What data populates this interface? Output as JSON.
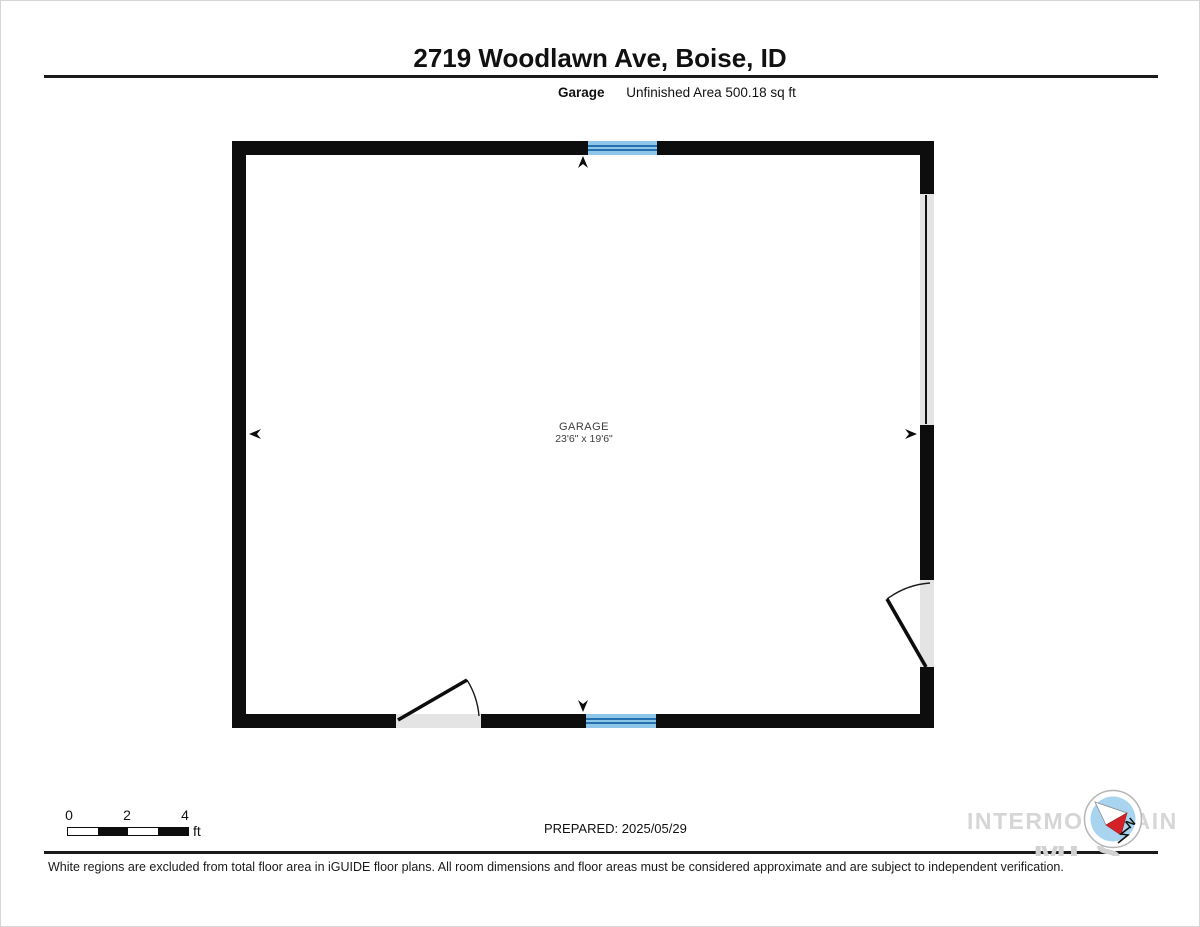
{
  "header": {
    "title": "2719 Woodlawn Ave, Boise, ID",
    "room_label": "Garage",
    "area_label": "Unfinished Area 500.18 sq ft"
  },
  "room": {
    "name": "GARAGE",
    "dimensions": "23'6\" x 19'6\""
  },
  "scale_bar": {
    "ticks": [
      "0",
      "2",
      "4"
    ],
    "unit": "ft"
  },
  "footer": {
    "prepared": "PREPARED: 2025/05/29",
    "disclaimer": "White regions are excluded from total floor area in iGUIDE floor plans. All room dimensions and floor areas must be considered approximate and are subject to independent verification."
  },
  "watermark": {
    "line1": "INTERMOUNTAIN",
    "line2": "MLS",
    "compass_label": "N"
  },
  "colors": {
    "wall": "#0d0d0d",
    "window_fill": "#8ec6e9",
    "window_stripe": "#2471ae",
    "opening_fill": "#e4e4e4",
    "watermark_gray": "#d6d6d6",
    "compass_blue": "#a9d4ef",
    "compass_red": "#d42127"
  }
}
